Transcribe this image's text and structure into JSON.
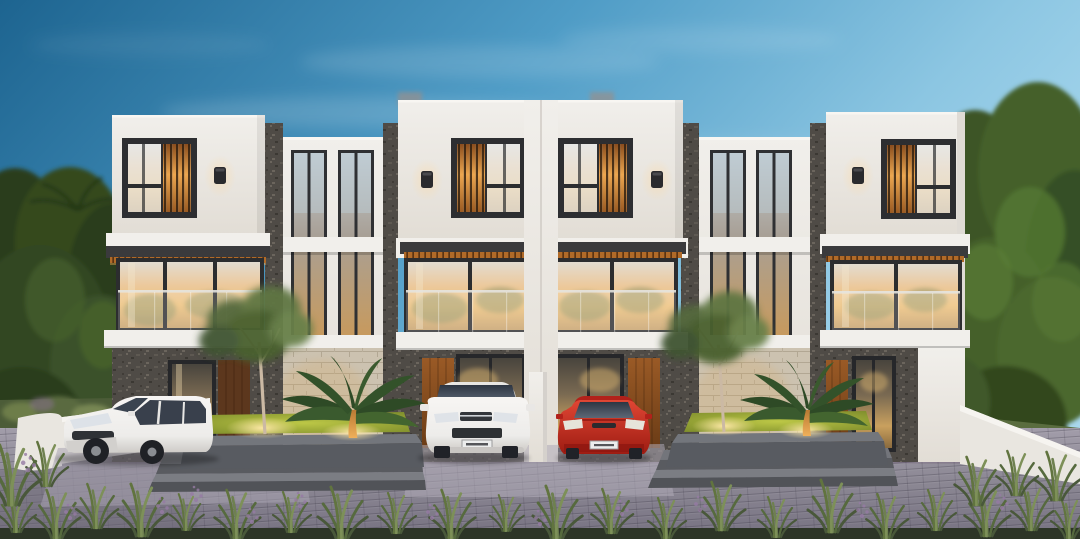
{
  "scene": {
    "type": "architectural-rendering",
    "time_of_day": "dusk",
    "subject": "Row of modern three-storey townhouses with lit interiors, carports, landscaped planters and parked cars",
    "units": [
      {
        "id": "unit-1",
        "accent_window": "wood-slat-right",
        "wall_lamp": true
      },
      {
        "id": "unit-2",
        "accent_window": "wood-slat-left",
        "wall_lamp": true
      },
      {
        "id": "unit-3",
        "accent_window": "wood-slat-right",
        "wall_lamp": true
      },
      {
        "id": "unit-4",
        "accent_window": "wood-slat-left",
        "wall_lamp": true
      }
    ],
    "connectors": [
      {
        "id": "connector-a",
        "feature": "double-height glass slots"
      },
      {
        "id": "connector-b",
        "feature": "double-height glass slots"
      }
    ],
    "cars": [
      {
        "id": "white-minivan",
        "color": "white",
        "position": "left-carport"
      },
      {
        "id": "white-suv",
        "color": "white",
        "position": "center-left-carport"
      },
      {
        "id": "red-hatchback",
        "color": "red",
        "position": "center-right-carport"
      }
    ],
    "landscaping": [
      "background-trees",
      "ornamental-trees",
      "fan-palms",
      "lit-planter-lawns",
      "foreground-grass",
      "purple-wildflowers"
    ],
    "hardscape": [
      "paver-driveway",
      "front-steps",
      "planter-curbs",
      "boundary-walls"
    ]
  },
  "colors": {
    "skyTop": "#1d6490",
    "skyMid": "#4f9cc6",
    "skyLight": "#a9d8ee",
    "wallWhite": "#f1efeb",
    "wallShade": "#dcd8d2",
    "frameDark": "#2d2e31",
    "fasciaDark": "#3a3a3c",
    "stoneDark": "#4f4b46",
    "stoneBeige": "#ccc2b0",
    "woodSlat": "#b06a28",
    "woodGlow": "#eca64f",
    "glassWarm": "#edc07a",
    "interiorGlow": "#f7d494",
    "windowTint": "#39404c",
    "treeDark": "#2e421f",
    "treeMid": "#43592b",
    "treeLight": "#5f7840",
    "grassLit": "#aab437",
    "grassGreen": "#55683c",
    "paver": "#8b8793",
    "paverLight": "#a29daa",
    "curb": "#585b61",
    "stepTop": "#7b7d83",
    "wallLow": "#e9e6e0",
    "carWhite": "#edecea",
    "carRed": "#c5271c",
    "lampBody": "#2a2a2d",
    "lampGlow": "#ffd9a0",
    "uplight": "#ffe9a8",
    "flower": "#967ba4",
    "soil": "#2d3527"
  }
}
